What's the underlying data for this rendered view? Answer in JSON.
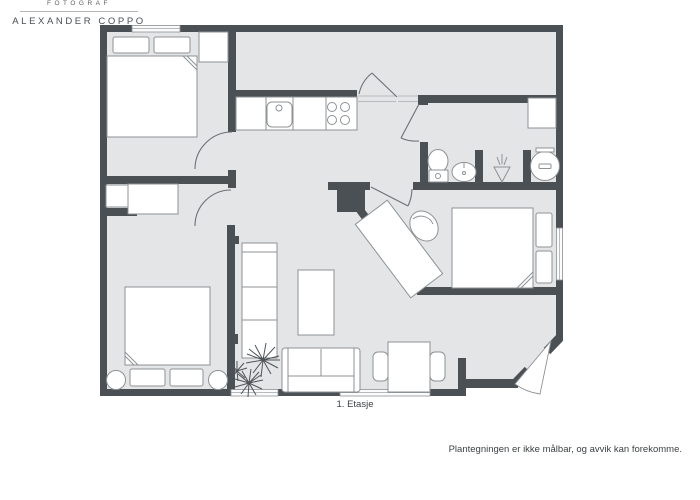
{
  "meta": {
    "floor_label": "1. Etasje",
    "disclaimer": "Plantegningen er ikke målbar, og avvik kan forekomme."
  },
  "credit": {
    "role": "FOTOGRAF",
    "name": "ALEXANDER COPPO"
  },
  "colors": {
    "wall": "#4b5055",
    "floor": "#e4e5e6",
    "furniture_outline": "#8d9296",
    "text": "#3d4245",
    "credit_text": "#5a5f63"
  },
  "fixtures": [
    "double-bed-top-left",
    "wardrobe",
    "double-bed-bottom-left",
    "bedside-table",
    "bedside-table",
    "desk-small",
    "closet-niche",
    "kitchen-counter",
    "kitchen-sink",
    "stove-burners",
    "toilet",
    "washbasin",
    "shower-drain",
    "washing-machine",
    "bathroom-cabinet",
    "double-bed-right",
    "desk-diagonal",
    "office-chair",
    "chimney",
    "bookshelf",
    "coffee-table",
    "sofa",
    "potted-plant",
    "dining-table",
    "dining-chair",
    "dining-chair"
  ]
}
